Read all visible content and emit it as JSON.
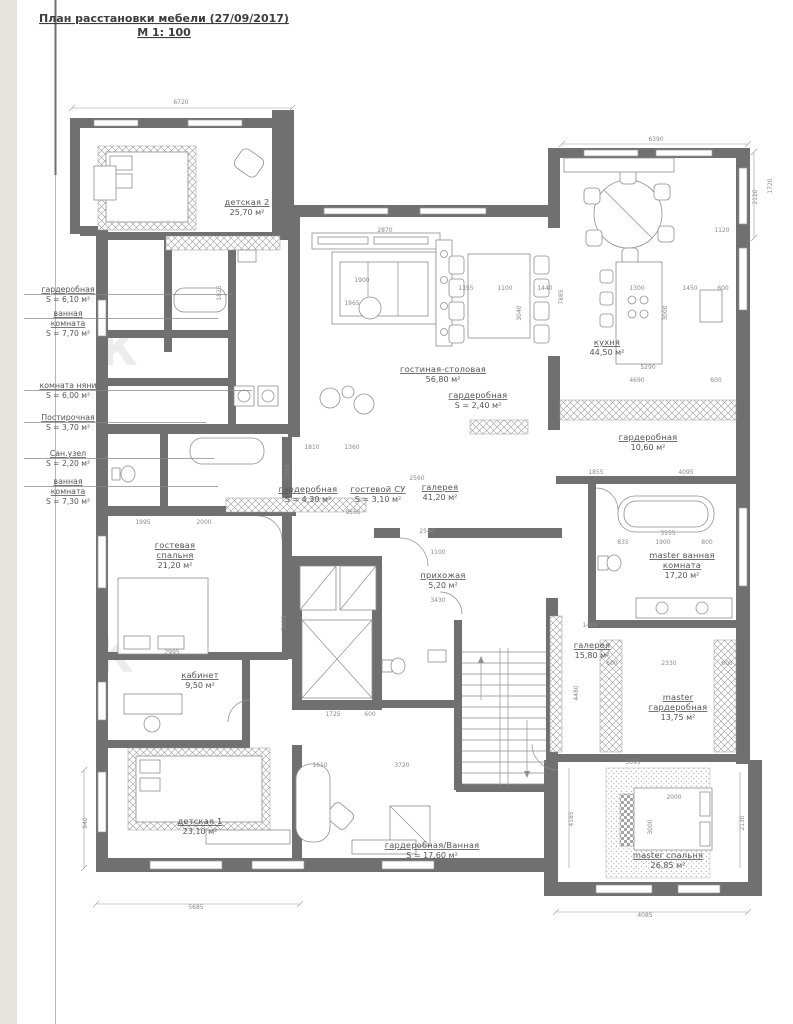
{
  "title": {
    "line1": "План расстановки мебели (27/09/2017)",
    "line2": "М 1: 100"
  },
  "watermark": "К",
  "colors": {
    "wall": "#707070",
    "line": "#8f8f8f",
    "text": "#555555",
    "dim": "#8a8a8a",
    "paper": "#ffffff",
    "edge_strip": "#e6e3df"
  },
  "callouts": [
    {
      "lines": [
        "гардеробная"
      ],
      "area": "S = 6,10 м²",
      "x": 68,
      "y": 292,
      "lx2": 232
    },
    {
      "lines": [
        "ванная",
        "комната"
      ],
      "area": "S = 7,70 м²",
      "x": 68,
      "y": 316,
      "lx2": 218
    },
    {
      "lines": [
        "комната няни"
      ],
      "area": "S = 6,00 м²",
      "x": 68,
      "y": 388,
      "lx2": 252
    },
    {
      "lines": [
        "Постирочная"
      ],
      "area": "S = 3,70 м²",
      "x": 68,
      "y": 420,
      "lx2": 206
    },
    {
      "lines": [
        "Сан.узел"
      ],
      "area": "S = 2,20 м²",
      "x": 68,
      "y": 456,
      "lx2": 214
    },
    {
      "lines": [
        "ванная",
        "комната"
      ],
      "area": "S = 7,30 м²",
      "x": 68,
      "y": 484,
      "lx2": 218
    }
  ],
  "rooms": [
    {
      "lines": [
        "детская 2"
      ],
      "area": "25,70 м²",
      "x": 247,
      "y": 205
    },
    {
      "lines": [
        "гостиная-столовая"
      ],
      "area": "56,80 м²",
      "x": 443,
      "y": 372
    },
    {
      "lines": [
        "гардеробная"
      ],
      "area": "S = 2,40 м²",
      "x": 478,
      "y": 398
    },
    {
      "lines": [
        "кухня"
      ],
      "area": "44,50 м²",
      "x": 607,
      "y": 345
    },
    {
      "lines": [
        "гардеробная"
      ],
      "area": "10,60 м²",
      "x": 648,
      "y": 440
    },
    {
      "lines": [
        "гардеробная"
      ],
      "area": "S = 4,30 м²",
      "x": 308,
      "y": 492
    },
    {
      "lines": [
        "гостевой СУ"
      ],
      "area": "S = 3,10 м²",
      "x": 378,
      "y": 492
    },
    {
      "lines": [
        "галерея"
      ],
      "area": "41,20 м²",
      "x": 440,
      "y": 490
    },
    {
      "lines": [
        "прихожая"
      ],
      "area": "5,20 м²",
      "x": 443,
      "y": 578
    },
    {
      "lines": [
        "гостевая",
        "спальня"
      ],
      "area": "21,20 м²",
      "x": 175,
      "y": 548
    },
    {
      "lines": [
        "master ванная",
        "комната"
      ],
      "area": "17,20 м²",
      "x": 682,
      "y": 558
    },
    {
      "lines": [
        "галерея"
      ],
      "area": "15,80 м²",
      "x": 592,
      "y": 648
    },
    {
      "lines": [
        "master",
        "гардеробная"
      ],
      "area": "13,75 м²",
      "x": 678,
      "y": 700
    },
    {
      "lines": [
        "кабинет"
      ],
      "area": "9,50 м²",
      "x": 200,
      "y": 678
    },
    {
      "lines": [
        "детская 1"
      ],
      "area": "23,10 м²",
      "x": 200,
      "y": 824
    },
    {
      "lines": [
        "гардеробная/Ванная"
      ],
      "area": "S = 17,60 м²",
      "x": 432,
      "y": 848
    },
    {
      "lines": [
        "master спальня"
      ],
      "area": "26,85 м²",
      "x": 668,
      "y": 858
    }
  ],
  "dimensions": [
    {
      "t": "6720",
      "x": 181,
      "y": 104
    },
    {
      "t": "6390",
      "x": 656,
      "y": 141
    },
    {
      "t": "2870",
      "x": 385,
      "y": 232
    },
    {
      "t": "1720",
      "x": 772,
      "y": 186,
      "r": 1
    },
    {
      "t": "2120",
      "x": 757,
      "y": 197,
      "r": 1
    },
    {
      "t": "1120",
      "x": 722,
      "y": 232
    },
    {
      "t": "1900",
      "x": 362,
      "y": 282
    },
    {
      "t": "1965",
      "x": 352,
      "y": 305
    },
    {
      "t": "1355",
      "x": 466,
      "y": 290
    },
    {
      "t": "1100",
      "x": 505,
      "y": 290
    },
    {
      "t": "1440",
      "x": 545,
      "y": 290
    },
    {
      "t": "3040",
      "x": 521,
      "y": 313,
      "r": 1
    },
    {
      "t": "7885",
      "x": 563,
      "y": 297,
      "r": 1
    },
    {
      "t": "1300",
      "x": 637,
      "y": 290
    },
    {
      "t": "1450",
      "x": 690,
      "y": 290
    },
    {
      "t": "600",
      "x": 723,
      "y": 290
    },
    {
      "t": "3000",
      "x": 667,
      "y": 313,
      "r": 1
    },
    {
      "t": "5290",
      "x": 648,
      "y": 369
    },
    {
      "t": "4690",
      "x": 637,
      "y": 382
    },
    {
      "t": "600",
      "x": 716,
      "y": 382
    },
    {
      "t": "4095",
      "x": 686,
      "y": 474
    },
    {
      "t": "1855",
      "x": 596,
      "y": 474
    },
    {
      "t": "1825",
      "x": 221,
      "y": 293,
      "r": 1
    },
    {
      "t": "1810",
      "x": 312,
      "y": 449
    },
    {
      "t": "1360",
      "x": 352,
      "y": 449
    },
    {
      "t": "1095",
      "x": 289,
      "y": 472,
      "r": 1
    },
    {
      "t": "2560",
      "x": 417,
      "y": 480
    },
    {
      "t": "9550",
      "x": 353,
      "y": 514
    },
    {
      "t": "2540",
      "x": 427,
      "y": 533
    },
    {
      "t": "1100",
      "x": 438,
      "y": 554
    },
    {
      "t": "3430",
      "x": 438,
      "y": 602
    },
    {
      "t": "1995",
      "x": 143,
      "y": 524
    },
    {
      "t": "2000",
      "x": 204,
      "y": 524
    },
    {
      "t": "2995",
      "x": 172,
      "y": 654
    },
    {
      "t": "7033",
      "x": 286,
      "y": 623,
      "r": 1
    },
    {
      "t": "1400",
      "x": 590,
      "y": 627
    },
    {
      "t": "4480",
      "x": 578,
      "y": 693,
      "r": 1
    },
    {
      "t": "3555",
      "x": 668,
      "y": 535
    },
    {
      "t": "835",
      "x": 623,
      "y": 544
    },
    {
      "t": "1900",
      "x": 663,
      "y": 544
    },
    {
      "t": "800",
      "x": 707,
      "y": 544
    },
    {
      "t": "2330",
      "x": 669,
      "y": 665
    },
    {
      "t": "600",
      "x": 612,
      "y": 665
    },
    {
      "t": "600",
      "x": 727,
      "y": 665
    },
    {
      "t": "5695",
      "x": 633,
      "y": 764
    },
    {
      "t": "2000",
      "x": 674,
      "y": 799
    },
    {
      "t": "3000",
      "x": 652,
      "y": 827,
      "r": 1
    },
    {
      "t": "4185",
      "x": 573,
      "y": 819,
      "r": 1
    },
    {
      "t": "2130",
      "x": 744,
      "y": 823,
      "r": 1
    },
    {
      "t": "4085",
      "x": 645,
      "y": 917
    },
    {
      "t": "5685",
      "x": 196,
      "y": 909
    },
    {
      "t": "940",
      "x": 87,
      "y": 823,
      "r": 1
    },
    {
      "t": "1610",
      "x": 320,
      "y": 767
    },
    {
      "t": "3720",
      "x": 402,
      "y": 767
    },
    {
      "t": "1725",
      "x": 333,
      "y": 716
    },
    {
      "t": "600",
      "x": 370,
      "y": 716
    }
  ]
}
